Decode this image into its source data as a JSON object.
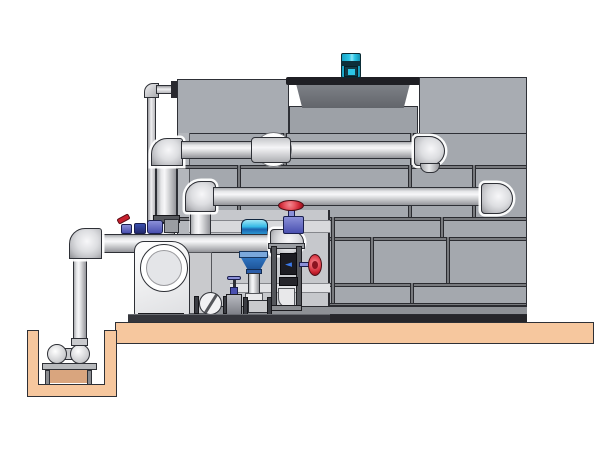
{
  "diagram": {
    "title": "Closed-circuit cooling tower with pump skid, valve train and sump pit — technical illustration",
    "type": "equipment-illustration",
    "background": "#ffffff"
  },
  "palette": {
    "bg": "#ffffff",
    "outline": "#2e3036",
    "tower_panel": "#a4a8ae",
    "tower_panel_light": "#b4b7bc",
    "tower_top_panel": "#a8acb2",
    "fan_deck": "#9da1a7",
    "backdrop": "#c6c8cc",
    "backdrop_rail": "#d8d9dc",
    "seam_dark": "#2a2b30",
    "basin_mid": "#8e9196",
    "basin_dark": "#26262a",
    "slab": "#f6c79e",
    "slab_shadow": "#d9a57e",
    "cowl": "#6e7177",
    "cowl_rim": "#1f1f24",
    "motor_cyan": "#2cc6e6",
    "motor_dark": "#0d2f3a",
    "red": "#c8202e",
    "red_light": "#e85560",
    "valve_blue": "#4a50b0",
    "valve_blue_light": "#8b90d8",
    "strainer_blue": "#2f74c0",
    "strainer_dark": "#1b4f92",
    "actuator_cyan": "#35b9e6",
    "actuator_band": "#1b65b0",
    "display_bg": "#1c1c22",
    "display_blue": "#3a78e8",
    "pump_white": "#ffffff",
    "pump_shade": "#dedfe2",
    "metal": "#c9cacd",
    "metal_dark": "#55575c",
    "flange": "#3a3c42",
    "skid_base": "#35363c"
  },
  "tower": {
    "horizontal_seams": [
      165,
      217,
      237,
      283,
      303
    ],
    "seam_bands": [
      {
        "y": 133,
        "h": 32,
        "xs": [
          283,
          410
        ]
      },
      {
        "y": 165,
        "h": 52,
        "xs": [
          237,
          408,
          472
        ]
      },
      {
        "y": 217,
        "h": 20,
        "xs": [
          331,
          440
        ]
      },
      {
        "y": 237,
        "h": 46,
        "xs": [
          331,
          370,
          446
        ]
      },
      {
        "y": 283,
        "h": 20,
        "xs": [
          331,
          410
        ]
      }
    ]
  },
  "flow_meter": {
    "glyph": "◄"
  },
  "components": [
    {
      "id": "cooling-tower",
      "label": "cooling tower casing with bolted panels"
    },
    {
      "id": "fan-motor",
      "label": "cyan fan motor on shroud"
    },
    {
      "id": "fan-shroud",
      "label": "axial fan shroud ring"
    },
    {
      "id": "upper-distribution-pipe",
      "label": "upper inlet distribution pipe with down elbow"
    },
    {
      "id": "mid-distribution-pipe",
      "label": "second distribution pipe with down elbow"
    },
    {
      "id": "makeup-line",
      "label": "small make-up / overflow line"
    },
    {
      "id": "suction-pipe",
      "label": "large horizontal pump header pipe"
    },
    {
      "id": "centrifugal-pump",
      "label": "end-suction centrifugal pump"
    },
    {
      "id": "check-valve",
      "label": "wafer check valve"
    },
    {
      "id": "gate-valve-red",
      "label": "gate valves with red handwheels"
    },
    {
      "id": "butterfly-valve-cyan",
      "label": "butterfly valve with cyan actuator"
    },
    {
      "id": "y-strainer",
      "label": "blue suction strainer cone"
    },
    {
      "id": "flow-meter",
      "label": "flow meter column with display"
    },
    {
      "id": "sump-pit",
      "label": "concrete sump pit"
    },
    {
      "id": "sump-pump",
      "label": "horizontal sump pump on stand"
    },
    {
      "id": "concrete-slab",
      "label": "concrete foundation slab"
    }
  ]
}
